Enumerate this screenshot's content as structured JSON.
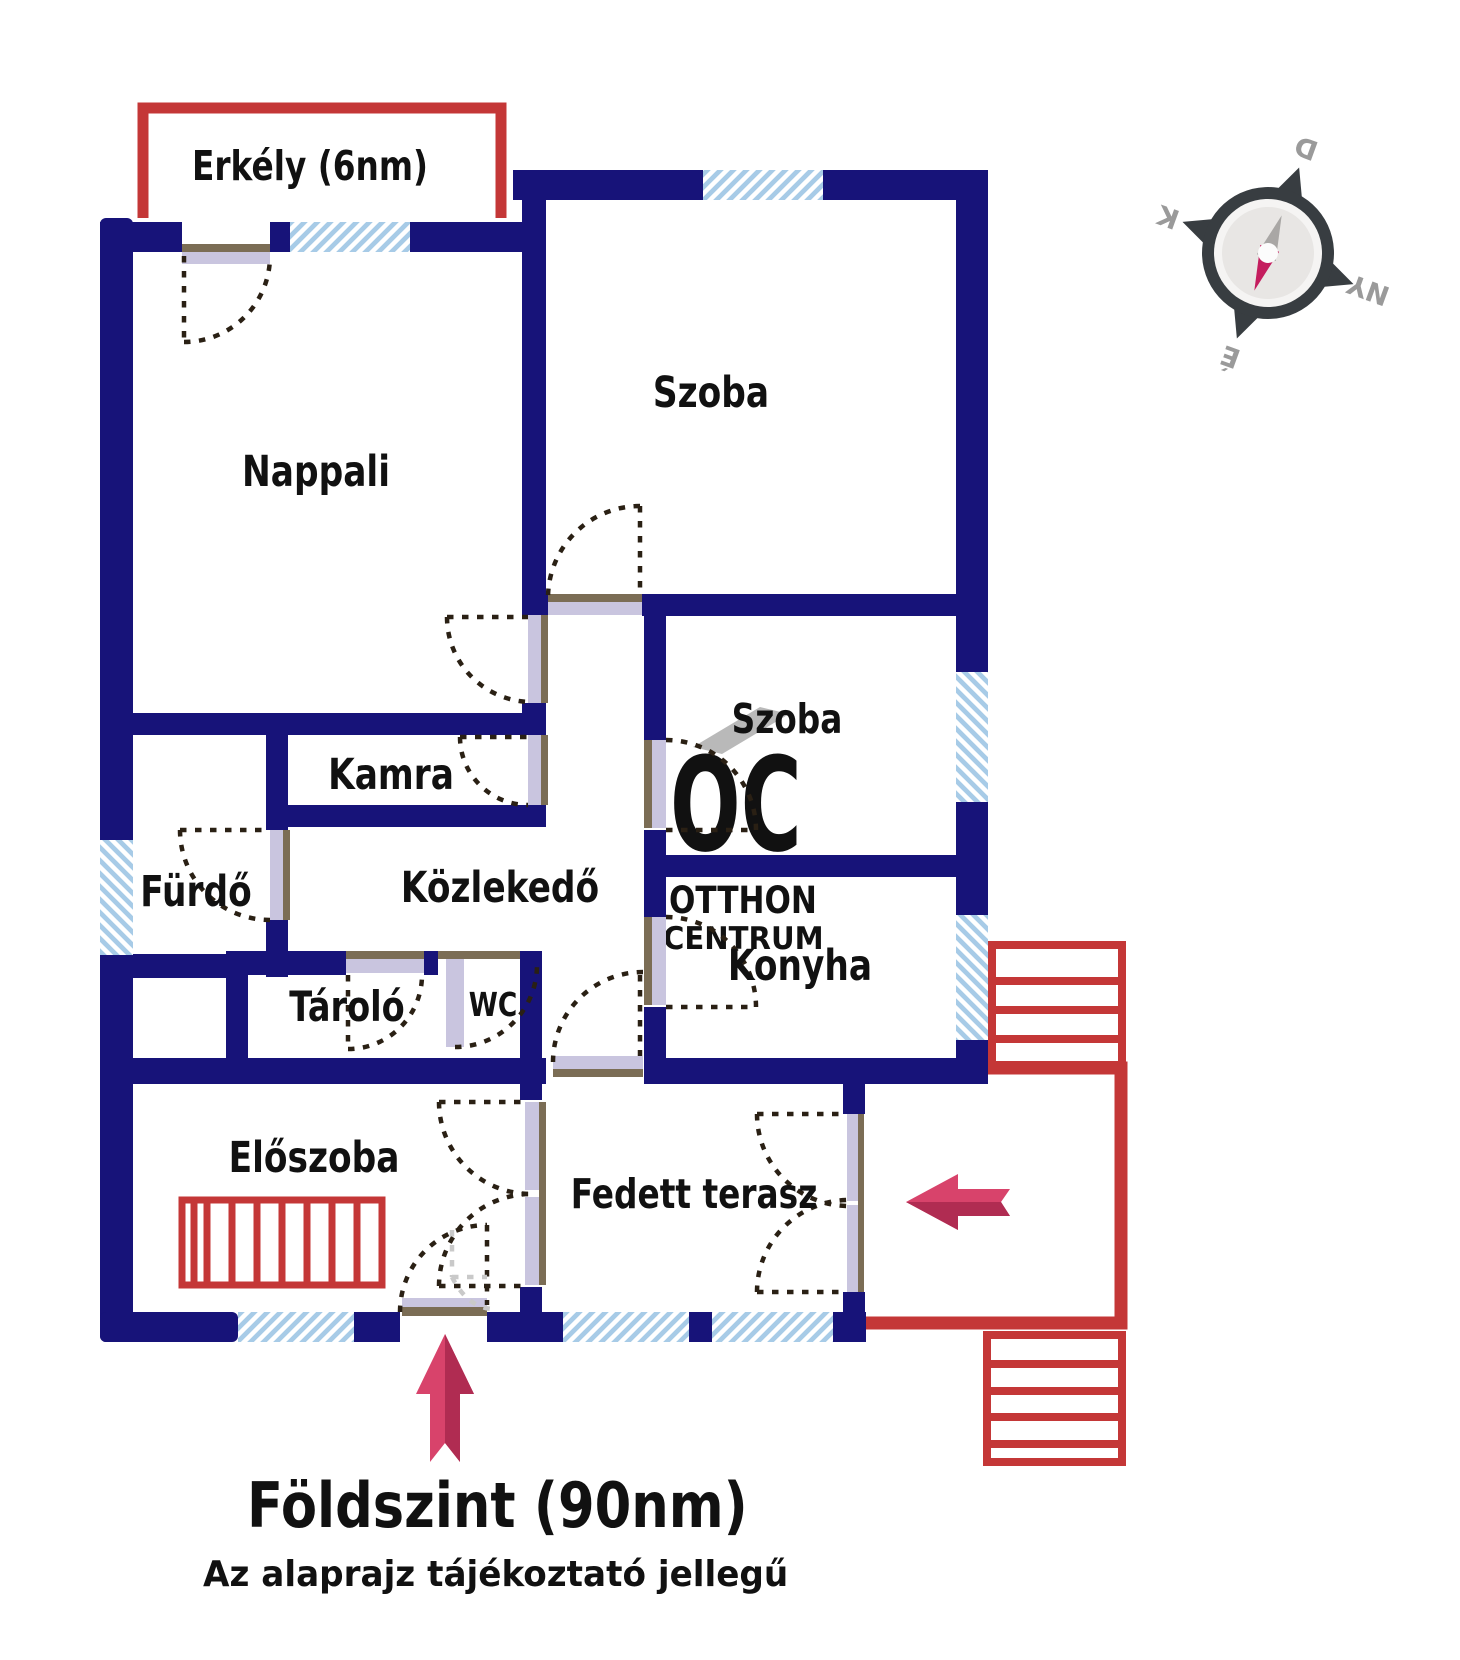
{
  "plan": {
    "floor_title": "Földszint (90nm)",
    "disclaimer": "Az alaprajz tájékoztató jellegű",
    "rooms": {
      "balcony": "Erkély (6nm)",
      "living": "Nappali",
      "room1": "Szoba",
      "room2": "Szoba",
      "pantry": "Kamra",
      "bathroom": "Fürdő",
      "hallway": "Közlekedő",
      "kitchen": "Konyha",
      "storage": "Tároló",
      "wc": "WC",
      "entry_hall": "Előszoba",
      "covered_terrace": "Fedett terasz"
    },
    "compass": {
      "north": "É",
      "south": "D",
      "east": "K",
      "west": "NY"
    },
    "watermark": {
      "logo": "OC",
      "line1": "OTTHON",
      "line2": "CENTRUM"
    },
    "colors": {
      "wall": "#171379",
      "window": "#a7cbe7",
      "outdoor_red": "#c43737",
      "arrow": "#d8436b",
      "arrow_shade": "#b02c52",
      "door_leaf": "#c9c5df",
      "door_jamb": "#7b6d55",
      "watermark_gray": "#b9b9b9",
      "compass_needle": "#c41d5e"
    }
  }
}
